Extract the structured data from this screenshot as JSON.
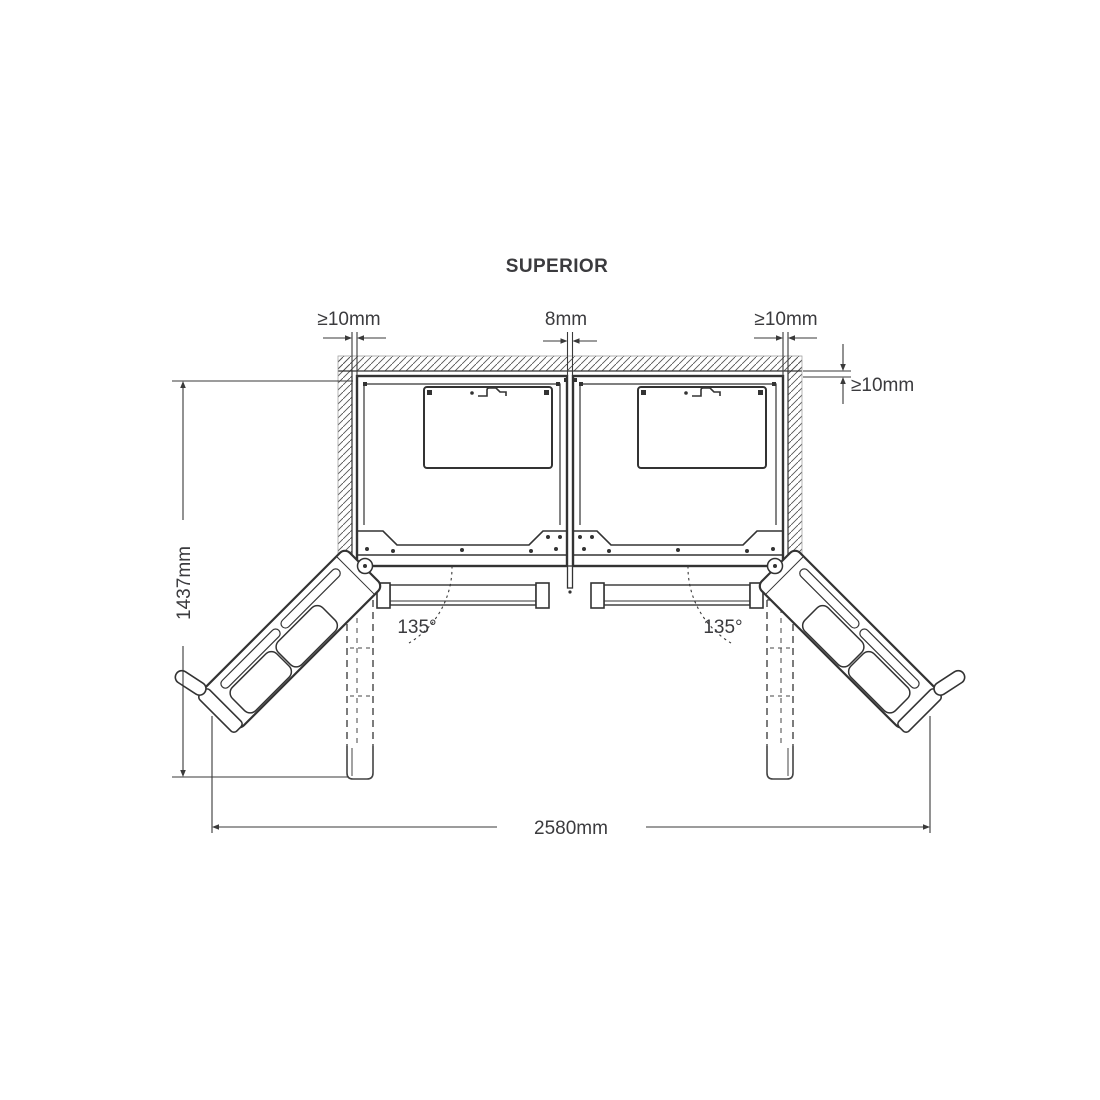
{
  "labels": {
    "title": "SUPERIOR",
    "top_left_clearance": "≥10mm",
    "top_center_gap": "8mm",
    "top_right_clearance": "≥10mm",
    "rear_clearance": "≥10mm",
    "depth_doors_open": "1437mm",
    "width_doors_open": "2580mm",
    "door_angle_left": "135°",
    "door_angle_right": "135°"
  },
  "colors": {
    "background": "#ffffff",
    "line": "#333333",
    "text": "#3b3b3e",
    "hatch": "#555555"
  }
}
